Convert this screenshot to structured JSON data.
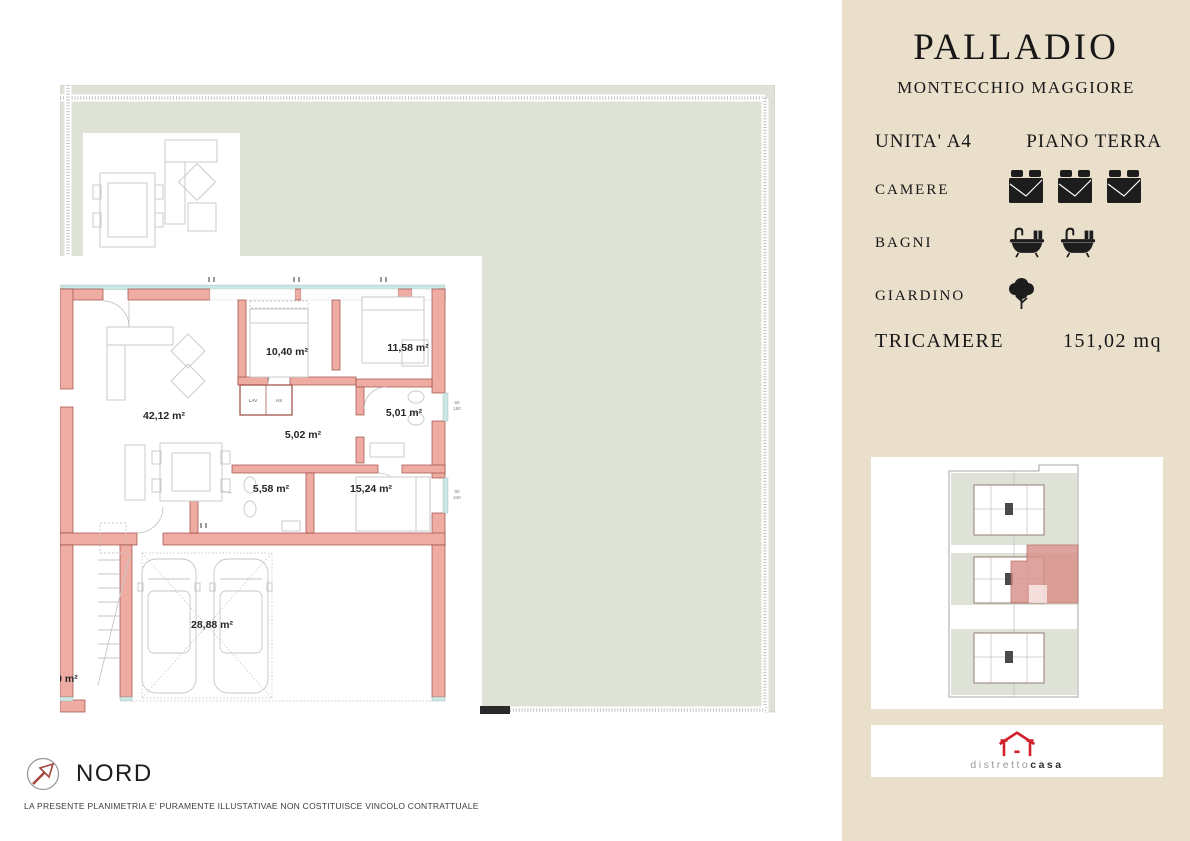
{
  "colors": {
    "sidebar-bg": "#e9dfcb",
    "ink": "#171717",
    "wall-fill": "#efaca3",
    "wall-line": "#9c4a42",
    "garden": "#dfe3d7",
    "glass": "#cbe7e4",
    "furniture": "#c6c6c6",
    "brand-red": "#d2202a",
    "highlight": "#d9908a"
  },
  "sidebar": {
    "title": "PALLADIO",
    "subtitle": "MONTECCHIO MAGGIORE",
    "unit": "UNITA' A4",
    "floor": "PIANO TERRA",
    "features": [
      {
        "label": "CAMERE",
        "icon": "bed-icon",
        "count": 3
      },
      {
        "label": "BAGNI",
        "icon": "bathtub-icon",
        "count": 2
      },
      {
        "label": "GIARDINO",
        "icon": "tree-icon",
        "count": 1
      }
    ],
    "type_label": "TRICAMERE",
    "total_area": "151,02 mq",
    "brand": {
      "light": "distretto",
      "bold": "casa"
    }
  },
  "floor_plan": {
    "room_labels": [
      "42,12 m²",
      "10,40 m²",
      "11,58 m²",
      "5,01 m²",
      "5,02 m²",
      "5,58 m²",
      "15,24 m²",
      "28,88 m²"
    ],
    "partial_label": "50 m²",
    "closets": [
      "LAV",
      "AS"
    ],
    "window_dims": [
      {
        "w": "60",
        "h": "160"
      },
      {
        "w": "90",
        "h": "240"
      }
    ]
  },
  "compass_label": "NORD",
  "disclaimer": "LA PRESENTE PLANIMETRIA E' PURAMENTE ILLUSTATIVAE NON COSTITUISCE VINCOLO CONTRATTUALE"
}
